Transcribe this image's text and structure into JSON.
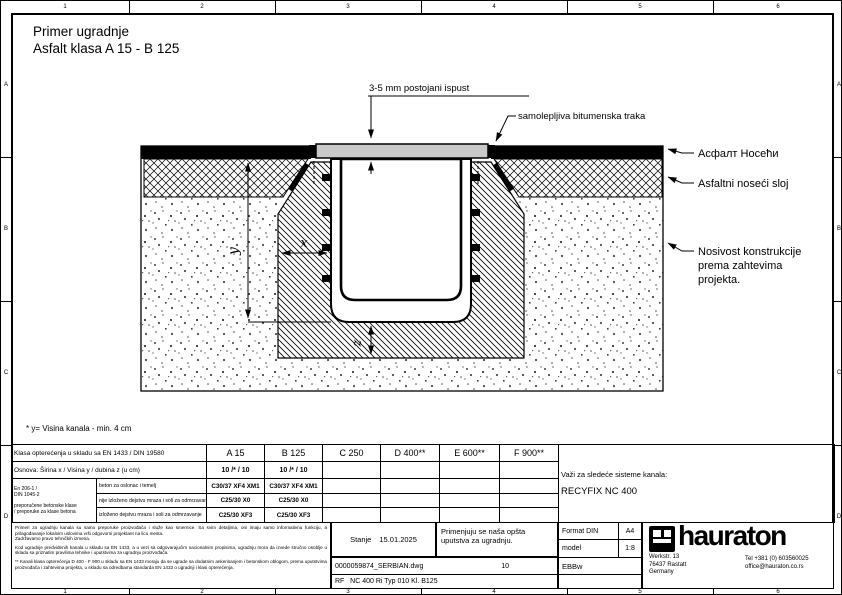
{
  "frame": {
    "top_numbers": [
      "1",
      "2",
      "3",
      "4",
      "5",
      "6"
    ],
    "bottom_numbers": [
      "1",
      "2",
      "3",
      "4",
      "5",
      "6"
    ],
    "left_letters": [
      "A",
      "B",
      "C",
      "D"
    ],
    "right_letters": [
      "A",
      "B",
      "C",
      "D"
    ]
  },
  "title": {
    "line1": "Primer ugradnje",
    "line2": "Asfalt klasa A 15 - B 125"
  },
  "drawing": {
    "callout_gap": "3-5 mm postojani ispust",
    "callout_tape": "samolepljiva bitumenska traka",
    "label_surface": "Асфалт Носећи",
    "label_base": "Asfaltni noseći sloj",
    "label_bearing_1": "Nosivost konstrukcije",
    "label_bearing_2": "prema zahtevima",
    "label_bearing_3": "projekta.",
    "dim_x": "x",
    "dim_y": "y",
    "dim_z": "z",
    "footnote": "* y= Visina kanala - min. 4 cm",
    "colors": {
      "grate": "#c9c9c9",
      "asphalt": "#000000"
    }
  },
  "spec_table": {
    "load_class_row": {
      "label": "Klasa opterećenja u skladu sa EN 1433 / DIN 19580",
      "values": [
        "A 15",
        "B 125",
        "C 250",
        "D 400**",
        "E 600**",
        "F 900**"
      ]
    },
    "foundation_row": {
      "label": "Osnova: Širina x / Visina y / dubina z (u cm)",
      "values": [
        "10 /* / 10",
        "10 /* / 10",
        "",
        "",
        "",
        ""
      ]
    },
    "concrete_group": {
      "standard_1": "En 206-1 /",
      "standard_2": "DIN 1045-2",
      "note_1": "preporučene betonske klase",
      "note_2": "/ preporuke za klase betona"
    },
    "concrete_rows": [
      {
        "label": "beton za oslonac i temelj",
        "values": [
          "C30/37 XF4 XM1",
          "C30/37 XF4 XM1",
          "",
          "",
          "",
          ""
        ]
      },
      {
        "label": "nije izloženo dejstvu mraza i soli za odmrzavanje",
        "values": [
          "C25/30 X0",
          "C25/30 X0",
          "",
          "",
          "",
          ""
        ]
      },
      {
        "label": "izloženo dejstvu mraza i soli za odmrzavanje",
        "values": [
          "C25/30 XF3",
          "C25/30 XF3",
          "",
          "",
          "",
          ""
        ]
      }
    ],
    "validity": {
      "label": "Važi za sledeće sisteme kanala:",
      "system": "RECYFIX NC 400"
    }
  },
  "titleblock": {
    "disclaimer": {
      "p1": "Primeri za ugradnju kanala su samo preporuke proizvođača i služe kao smernice. Sa svim detaljima, oni imaju samo informativnu funkciju, a prilagođavanje lokalnim uslovima vrši odgovorni projektant na licu mesta.\nZadržavamo pravo tehničkih izmena.",
      "p2": "Kod ugradnje predviđenih kanala u skladu sa EN 1433, a u vezi sa odgovarajućim nacionalnim propisima, ugradnju mora da izvede stručno osoblje u skladu sa priznatim pravilima tehnike i uputstvima za ugradnju proizvođača.",
      "p3": "** Kanali klasa opterećenja D 400 - F 900 u skladu sa EN 1433 moraju da se ugrade sa dodatnim ankerisanjem i betonskom oblogom, prema uputstvima proizvođača i zahtevima projekta, u skladu sa odredbama standarda EN 1433 o ugradnji i klasi opterećenja."
    },
    "status_label": "Stanje",
    "status_date": "15.01.2025",
    "note": "Primenjuju se naša opšta uputstva za ugradnju.",
    "format_label": "Format DIN",
    "format_value": "A4",
    "scale_label": "model",
    "scale_value": "1:8",
    "code": "EBBw",
    "file_name": "0000059874_SERBIAN.dwg",
    "sheet": "10",
    "product": "RF   NC 400 Ri Typ 010 Kl. B125",
    "brand": {
      "wordmark": "hauraton",
      "address_1": "Werkstr. 13",
      "address_2": "76437 Rastatt",
      "address_3": "Germany",
      "contact_1": "Tel +381 (0) 603560025",
      "contact_2": "office@hauraton.co.rs"
    }
  }
}
